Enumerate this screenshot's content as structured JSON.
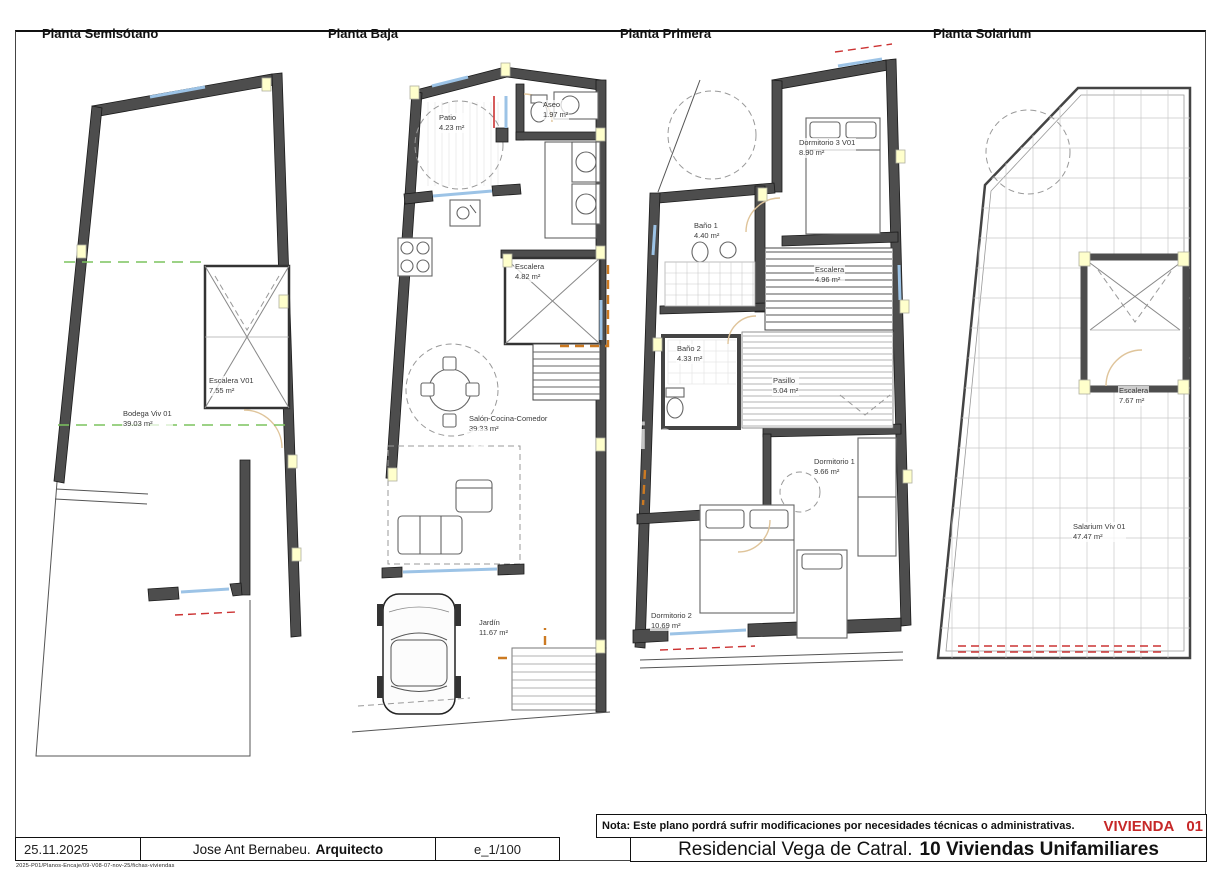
{
  "plans": [
    {
      "title": "Planta Semisótano",
      "rooms": [
        {
          "name": "Escalera V01",
          "area": "7.55 m²"
        },
        {
          "name": "Bodega Viv 01",
          "area": "39.03 m²"
        }
      ]
    },
    {
      "title": "Planta Baja",
      "rooms": [
        {
          "name": "Patio",
          "area": "4.23 m²"
        },
        {
          "name": "Aseo",
          "area": "1.97 m²"
        },
        {
          "name": "Escalera",
          "area": "4.82 m²"
        },
        {
          "name": "Salón-Cocina-Comedor",
          "area": "39.33 m²"
        },
        {
          "name": "Jardín",
          "area": "11.67 m²"
        }
      ]
    },
    {
      "title": "Planta Primera",
      "rooms": [
        {
          "name": "Dormitorio 3 V01",
          "area": "8.90 m²"
        },
        {
          "name": "Baño 1",
          "area": "4.40 m²"
        },
        {
          "name": "Escalera",
          "area": "4.96 m²"
        },
        {
          "name": "Baño 2",
          "area": "4.33 m²"
        },
        {
          "name": "Pasillo",
          "area": "5.04 m²"
        },
        {
          "name": "Dormitorio 1",
          "area": "9.66 m²"
        },
        {
          "name": "Dormitorio 2",
          "area": "10.69 m²"
        }
      ]
    },
    {
      "title": "Planta Solarium",
      "rooms": [
        {
          "name": "Escalera",
          "area": "7.67 m²"
        },
        {
          "name": "Salarium Viv 01",
          "area": "47.47 m²"
        }
      ]
    }
  ],
  "watermark": "p sin",
  "titleblock": {
    "date": "25.11.2025",
    "architect_name": "Jose Ant Bernabeu.",
    "architect_title": "Arquitecto",
    "scale": "e_1/100",
    "nota": "Nota: Este plano pordrá sufrir modificaciones por necesidades técnicas o administrativas.",
    "vivienda_label": "VIVIENDA",
    "vivienda_number": "01",
    "project_name": "Residencial Vega de Catral.",
    "project_subtitle": "10 Viviendas Unifamiliares",
    "file_reference": "2025-P01/Planos-Encaje/09-V08-07-nov-25/fichas-viviendas"
  },
  "colors": {
    "wall_gray": "#4d4d4d",
    "accent_red": "#c62828",
    "window_blue": "#9cc3e6",
    "door_orange": "#cc7a22",
    "dashed_green": "#7cc45e",
    "highlight_yellow": "#ffffcc"
  }
}
